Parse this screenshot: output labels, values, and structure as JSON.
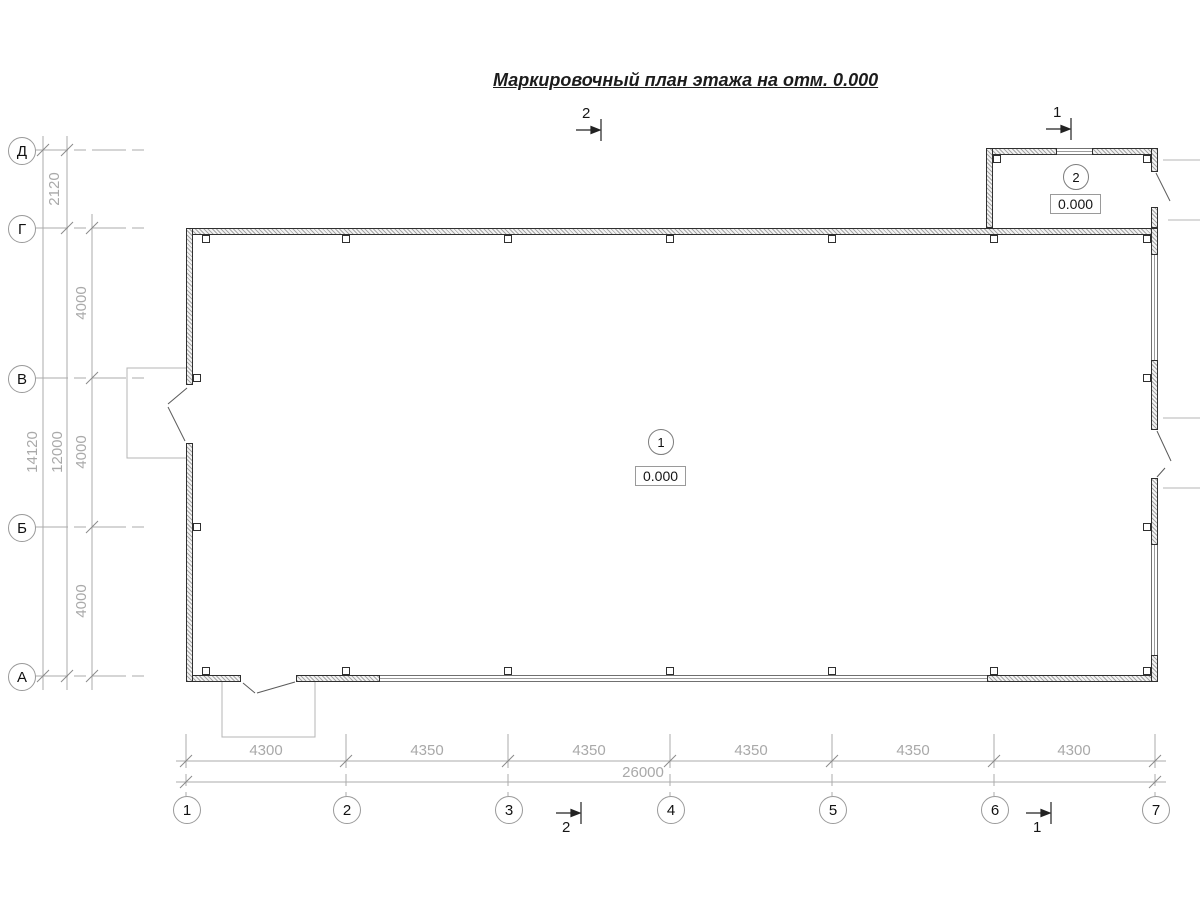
{
  "title": "Маркировочный план этажа на отм. 0.000",
  "axes": {
    "rows": [
      {
        "label": "Д"
      },
      {
        "label": "Г"
      },
      {
        "label": "В"
      },
      {
        "label": "Б"
      },
      {
        "label": "А"
      }
    ],
    "cols": [
      {
        "label": "1"
      },
      {
        "label": "2"
      },
      {
        "label": "3"
      },
      {
        "label": "4"
      },
      {
        "label": "5"
      },
      {
        "label": "6"
      },
      {
        "label": "7"
      }
    ]
  },
  "dimensions": {
    "vertical": {
      "span_d_g": "2120",
      "span_g_v": "4000",
      "span_v_b": "4000",
      "span_b_a": "4000",
      "subtotal": "12000",
      "total": "14120"
    },
    "horizontal": {
      "segments": [
        "4300",
        "4350",
        "4350",
        "4350",
        "4350",
        "4300"
      ],
      "total": "26000"
    }
  },
  "rooms": [
    {
      "number": "1",
      "elevation": "0.000"
    },
    {
      "number": "2",
      "elevation": "0.000"
    }
  ],
  "sections": [
    {
      "label": "1"
    },
    {
      "label": "2"
    }
  ]
}
